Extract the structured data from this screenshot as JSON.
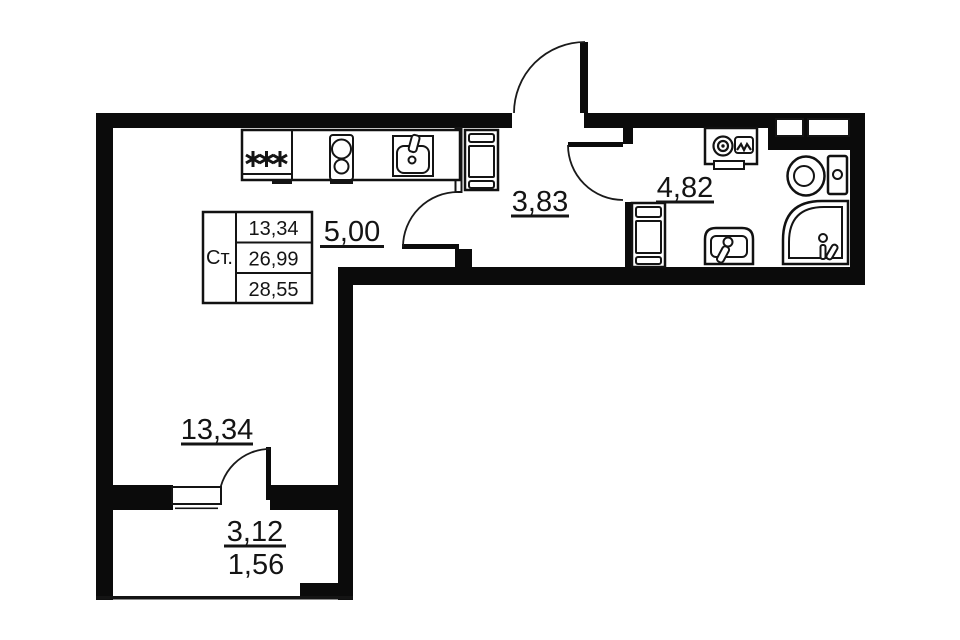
{
  "plan": {
    "type": "apartment-floor-plan-studio"
  },
  "rooms": {
    "kitchen": {
      "area": "5,00"
    },
    "hallway": {
      "area": "3,83"
    },
    "bathroom": {
      "area": "4,82"
    },
    "living_room": {
      "area": "13,34"
    },
    "balcony": {
      "area": "3,12",
      "area_reduced": "1,56"
    }
  },
  "area_table": {
    "row_label": "Ст.",
    "values": [
      "13,34",
      "26,99",
      "28,55"
    ]
  },
  "symbols": {
    "refrigerator_stars": "✳✳✳",
    "fixtures": [
      "refrigerator",
      "stove-2-burner",
      "kitchen-sink",
      "wardrobe",
      "washing-machine",
      "cabinet",
      "toilet",
      "corner-shower",
      "washbasin",
      "vent-shaft"
    ]
  },
  "colors": {
    "wall": "#0b0b0b",
    "line": "#141414",
    "background": "#ffffff",
    "text": "#141414"
  }
}
